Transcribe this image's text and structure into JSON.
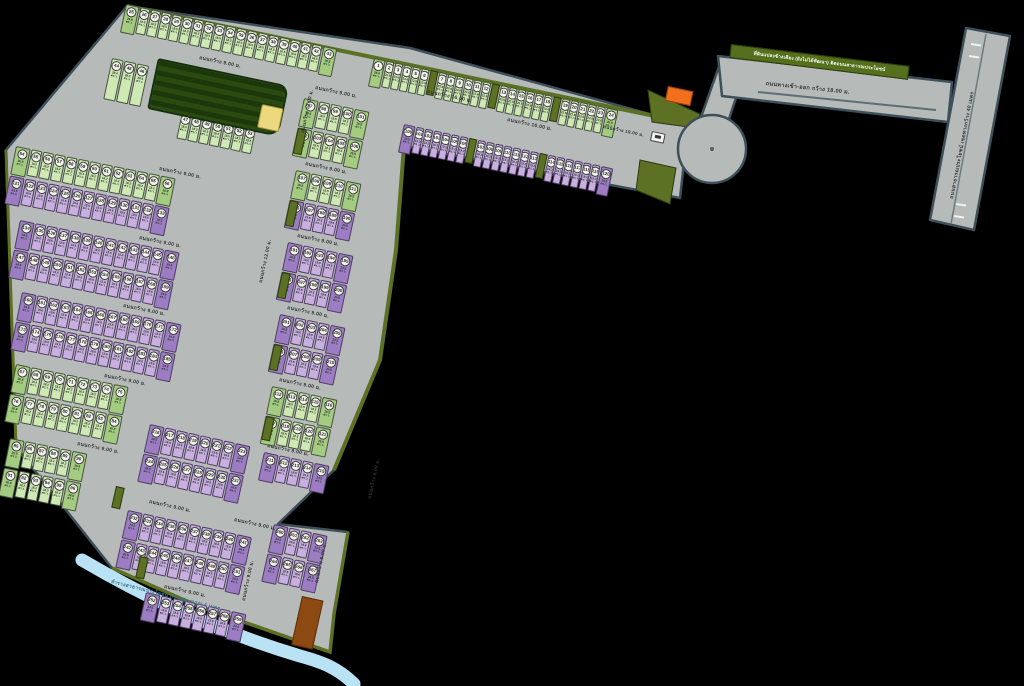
{
  "colors": {
    "background": "#000000",
    "road": "#b6bab9",
    "road_border": "#3d5059",
    "plot_green": "#cfe9b4",
    "plot_green_dark": "#a3cc80",
    "plot_purple": "#c9afe0",
    "plot_purple_dark": "#9c7cc2",
    "park": "#26450f",
    "hedge": "#5d7124",
    "canal": "#b9e2f4",
    "accent_orange": "#f26f1e",
    "accent_yellow": "#ecd97f",
    "accent_brown": "#8c4a12"
  },
  "labels": {
    "road9": "ถนนกว้าง 9.00 ม.",
    "road12": "ถนนกว้าง 12.00 ม.",
    "road16": "ถนนกว้าง 16.00 ม.",
    "road19": "ถนนกว้าง 19.00 ม.",
    "road6": "ถนนกว้าง 6.00 ม.",
    "entrance": "ถนนทางเข้า-ออก กว้าง 18.00 ม.",
    "main_road": "ถนนสาธารณประโยชน์ เขตทางกว้าง 40 เมตร",
    "boundary": "ที่ดินแปลงข้างเคียง (ยังไม่ได้พัฒนา) ติดถนนสาธารณประโยชน์",
    "canal": "ลำรางสาธารณประโยชน์ กว้างประมาณ 4 เมตร",
    "area_unit": "ตร.ว."
  },
  "numbering": {
    "green_start": 1,
    "purple_start": 100
  },
  "blocks": [
    {
      "name": "top-strip-green-row",
      "x": 374,
      "y": 58,
      "rot": 12,
      "rows": [
        {
          "c": "g",
          "segs": [
            6,
            -1,
            6,
            -1,
            6,
            -1,
            6
          ],
          "cw": 8,
          "a": "23.6",
          "ae": "26.8",
          "e": 1
        }
      ]
    },
    {
      "name": "top-strip-purple-row",
      "x": 404,
      "y": 124,
      "rot": 12,
      "rows": [
        {
          "c": "p",
          "segs": [
            7,
            -1,
            7,
            -1,
            7
          ],
          "cw": 8,
          "a": "19.2",
          "ae": "24.5",
          "e": 1
        }
      ]
    },
    {
      "name": "row-top",
      "x": 126,
      "y": 4,
      "rot": 12,
      "rows": [
        {
          "c": "g",
          "n": 19,
          "cw": 10,
          "a": "18.5",
          "ae": "26.8",
          "e": 1
        }
      ]
    },
    {
      "name": "row-park-side",
      "x": 112,
      "y": 58,
      "rot": 12,
      "rows": [
        {
          "c": "g",
          "n": 3,
          "cw": 12,
          "h": 42,
          "a": "28.4"
        }
      ]
    },
    {
      "name": "row-below-park",
      "x": 182,
      "y": 112,
      "rot": 12,
      "rows": [
        {
          "c": "g",
          "n": 7,
          "cw": 10,
          "a": "18.5"
        }
      ]
    },
    {
      "name": "row-west-2",
      "x": 16,
      "y": 146,
      "rot": 11.5,
      "rows": [
        {
          "c": "g",
          "n": 13,
          "a": "18.2",
          "ae": "26.8",
          "e": 1
        },
        {
          "c": "p",
          "n": 13,
          "a": "19.6",
          "ae": "24.5",
          "e": 1
        }
      ]
    },
    {
      "name": "row-west-3",
      "x": 20,
      "y": 220,
      "rot": 11.5,
      "rows": [
        {
          "c": "p",
          "n": 13,
          "a": "19.6",
          "ae": "24.5",
          "e": 1
        },
        {
          "c": "p",
          "n": 13,
          "a": "19.6",
          "ae": "24.5",
          "e": 1
        }
      ]
    },
    {
      "name": "row-west-4",
      "x": 22,
      "y": 292,
      "rot": 11.5,
      "rows": [
        {
          "c": "p",
          "n": 13,
          "a": "19.6",
          "ae": "24.5",
          "e": 1
        },
        {
          "c": "p",
          "n": 13,
          "a": "19.6",
          "ae": "24.5",
          "e": 1
        }
      ]
    },
    {
      "name": "row-west-5",
      "x": 16,
      "y": 364,
      "rot": 11.5,
      "rows": [
        {
          "c": "g",
          "n": 9,
          "a": "18.2",
          "ae": "26.8",
          "e": 1
        },
        {
          "c": "g",
          "n": 9,
          "a": "18.2",
          "ae": "26.8",
          "e": 1
        }
      ]
    },
    {
      "name": "row-west-6",
      "x": 10,
      "y": 438,
      "rot": 11.5,
      "rows": [
        {
          "c": "g",
          "n": 6,
          "a": "18.2",
          "ae": "26.8",
          "e": 1
        },
        {
          "c": "g",
          "n": 6,
          "a": "18.2",
          "ae": "26.8",
          "e": 1
        }
      ]
    },
    {
      "name": "row-mid-1",
      "x": 304,
      "y": 98,
      "rot": 12,
      "rows": [
        {
          "c": "g",
          "n": 5,
          "a": "18.5",
          "ae": "26.8",
          "e": 1
        },
        {
          "c": "g",
          "n": 5,
          "a": "18.5",
          "ae": "26.8",
          "e": 1
        }
      ]
    },
    {
      "name": "row-mid-2",
      "x": 296,
      "y": 170,
      "rot": 12,
      "rows": [
        {
          "c": "g",
          "n": 5,
          "a": "18.5",
          "ae": "26.8",
          "e": 1
        },
        {
          "c": "p",
          "n": 5,
          "a": "19.6",
          "ae": "24.5",
          "e": 1
        }
      ]
    },
    {
      "name": "row-mid-3",
      "x": 288,
      "y": 242,
      "rot": 12,
      "rows": [
        {
          "c": "p",
          "n": 5,
          "a": "19.6",
          "ae": "24.5",
          "e": 1
        },
        {
          "c": "p",
          "n": 5,
          "a": "19.6",
          "ae": "24.5",
          "e": 1
        }
      ]
    },
    {
      "name": "row-mid-4",
      "x": 280,
      "y": 314,
      "rot": 12,
      "rows": [
        {
          "c": "p",
          "n": 5,
          "a": "19.6",
          "ae": "24.5",
          "e": 1
        },
        {
          "c": "p",
          "n": 5,
          "a": "19.6",
          "ae": "24.5",
          "e": 1
        }
      ]
    },
    {
      "name": "row-mid-5",
      "x": 272,
      "y": 386,
      "rot": 12,
      "rows": [
        {
          "c": "g",
          "n": 5,
          "a": "18.5",
          "ae": "26.8",
          "e": 1
        },
        {
          "c": "g",
          "n": 5,
          "a": "18.5",
          "ae": "26.8",
          "e": 1
        }
      ]
    },
    {
      "name": "row-mid-6",
      "x": 264,
      "y": 452,
      "rot": 12,
      "rows": [
        {
          "c": "p",
          "n": 5,
          "a": "19.6",
          "ae": "24.5",
          "e": 1
        }
      ]
    },
    {
      "name": "row-south-1",
      "x": 150,
      "y": 424,
      "rot": 12.5,
      "rows": [
        {
          "c": "p",
          "n": 8,
          "a": "19.6",
          "ae": "24.5",
          "e": 1
        },
        {
          "c": "p",
          "n": 8,
          "a": "19.6",
          "ae": "24.5",
          "e": 1
        }
      ]
    },
    {
      "name": "row-south-2",
      "x": 128,
      "y": 510,
      "rot": 12.5,
      "rows": [
        {
          "c": "p",
          "n": 10,
          "a": "19.6",
          "ae": "24.5",
          "e": 1
        },
        {
          "c": "p",
          "n": 10,
          "a": "19.6",
          "ae": "24.5",
          "e": 1
        }
      ]
    },
    {
      "name": "row-south-3",
      "x": 146,
      "y": 592,
      "rot": 12.5,
      "rows": [
        {
          "c": "p",
          "n": 8,
          "a": "19.6",
          "ae": "24.5",
          "e": 1
        }
      ]
    },
    {
      "name": "row-south-east",
      "x": 274,
      "y": 524,
      "rot": 12.5,
      "rows": [
        {
          "c": "p",
          "n": 4,
          "a": "19.6",
          "ae": "24.5",
          "e": 1
        },
        {
          "c": "p",
          "n": 4,
          "a": "19.6",
          "ae": "24.5",
          "e": 1
        }
      ]
    }
  ],
  "features": [
    {
      "t": "rect",
      "name": "park",
      "x": 158,
      "y": 58,
      "w": 134,
      "h": 52,
      "rot": 12,
      "cls": "feat park"
    },
    {
      "t": "rect",
      "name": "clubhouse-yellow-plot",
      "x": 262,
      "y": 104,
      "w": 22,
      "h": 24,
      "rot": 12,
      "cls": "feat yellow"
    },
    {
      "t": "rect",
      "name": "sales-office-orange",
      "x": 668,
      "y": 86,
      "w": 26,
      "h": 15,
      "rot": 12,
      "cls": "feat orange"
    },
    {
      "t": "rect",
      "name": "brown-plot",
      "x": 302,
      "y": 596,
      "w": 22,
      "h": 50,
      "rot": 12.5,
      "cls": "feat brown"
    },
    {
      "t": "rect",
      "name": "gate-icon",
      "x": 652,
      "y": 131,
      "w": 14,
      "h": 10,
      "rot": 12,
      "cls": "feat gate"
    },
    {
      "t": "rect",
      "name": "hedge-separator",
      "x": 298,
      "y": 128,
      "w": 9,
      "h": 26,
      "rot": 12,
      "cls": "feat sep"
    },
    {
      "t": "rect",
      "name": "hedge-separator",
      "x": 290,
      "y": 200,
      "w": 9,
      "h": 26,
      "rot": 12,
      "cls": "feat sep"
    },
    {
      "t": "rect",
      "name": "hedge-separator",
      "x": 282,
      "y": 272,
      "w": 9,
      "h": 26,
      "rot": 12,
      "cls": "feat sep"
    },
    {
      "t": "rect",
      "name": "hedge-separator",
      "x": 274,
      "y": 344,
      "w": 9,
      "h": 26,
      "rot": 12,
      "cls": "feat sep"
    },
    {
      "t": "rect",
      "name": "hedge-separator",
      "x": 266,
      "y": 416,
      "w": 9,
      "h": 24,
      "rot": 12,
      "cls": "feat sep"
    },
    {
      "t": "rect",
      "name": "hedge-separator",
      "x": 116,
      "y": 486,
      "w": 9,
      "h": 22,
      "rot": 12.5,
      "cls": "feat sep"
    },
    {
      "t": "rect",
      "name": "hedge-separator",
      "x": 140,
      "y": 556,
      "w": 9,
      "h": 22,
      "rot": 12.5,
      "cls": "feat sep"
    },
    {
      "t": "bar",
      "name": "boundary-strip",
      "k": "boundary",
      "x": 731,
      "y": 44,
      "w": 180,
      "h": 14,
      "rot": 7
    },
    {
      "t": "lab",
      "k": "road9",
      "x": 200,
      "y": 54,
      "rot": 12
    },
    {
      "t": "lab",
      "k": "road9",
      "x": 316,
      "y": 84,
      "rot": 12
    },
    {
      "t": "lab",
      "k": "road9",
      "x": 160,
      "y": 165,
      "rot": 11.5
    },
    {
      "t": "lab",
      "k": "road9",
      "x": 140,
      "y": 234,
      "rot": 11.5
    },
    {
      "t": "lab",
      "k": "road9",
      "x": 124,
      "y": 302,
      "rot": 11.5
    },
    {
      "t": "lab",
      "k": "road9",
      "x": 105,
      "y": 372,
      "rot": 11.5
    },
    {
      "t": "lab",
      "k": "road9",
      "x": 78,
      "y": 440,
      "rot": 11.5
    },
    {
      "t": "lab",
      "k": "road9",
      "x": 306,
      "y": 160,
      "rot": 12
    },
    {
      "t": "lab",
      "k": "road9",
      "x": 298,
      "y": 232,
      "rot": 12
    },
    {
      "t": "lab",
      "k": "road9",
      "x": 288,
      "y": 304,
      "rot": 12
    },
    {
      "t": "lab",
      "k": "road9",
      "x": 280,
      "y": 376,
      "rot": 12
    },
    {
      "t": "lab",
      "k": "road9",
      "x": 268,
      "y": 442,
      "rot": 12
    },
    {
      "t": "lab",
      "k": "road9",
      "x": 150,
      "y": 498,
      "rot": 12.5
    },
    {
      "t": "lab",
      "k": "road9",
      "x": 235,
      "y": 516,
      "rot": 12.5
    },
    {
      "t": "lab",
      "k": "road9",
      "x": 165,
      "y": 583,
      "rot": 12.5
    },
    {
      "t": "lab",
      "k": "road16",
      "x": 428,
      "y": 88,
      "rot": 12
    },
    {
      "t": "lab",
      "k": "road16",
      "x": 508,
      "y": 116,
      "rot": 12
    },
    {
      "t": "lab",
      "k": "road19",
      "x": 604,
      "y": 123,
      "rot": 12,
      "fs": 4.5
    },
    {
      "t": "lab",
      "k": "road12",
      "x": 299,
      "y": 132,
      "rot": -78,
      "fs": 4.8
    },
    {
      "t": "lab",
      "k": "road12",
      "x": 257,
      "y": 282,
      "rot": -78,
      "fs": 4.8
    },
    {
      "t": "lab",
      "k": "road9",
      "x": 366,
      "y": 498,
      "rot": -78,
      "fs": 4.8
    },
    {
      "t": "lab",
      "k": "road9",
      "x": 240,
      "y": 600,
      "rot": -78,
      "fs": 4.8
    },
    {
      "t": "lab",
      "k": "road6",
      "x": 313,
      "y": 582,
      "rot": -78,
      "fs": 4.8
    },
    {
      "t": "lab",
      "k": "entrance",
      "x": 766,
      "y": 80,
      "rot": 6,
      "fs": 5.5
    },
    {
      "t": "lab",
      "k": "main_road",
      "x": 948,
      "y": 198,
      "rot": -79,
      "fs": 5
    },
    {
      "t": "lab",
      "k": "canal",
      "x": 112,
      "y": 578,
      "rot": 14,
      "cls": "lab water"
    }
  ]
}
